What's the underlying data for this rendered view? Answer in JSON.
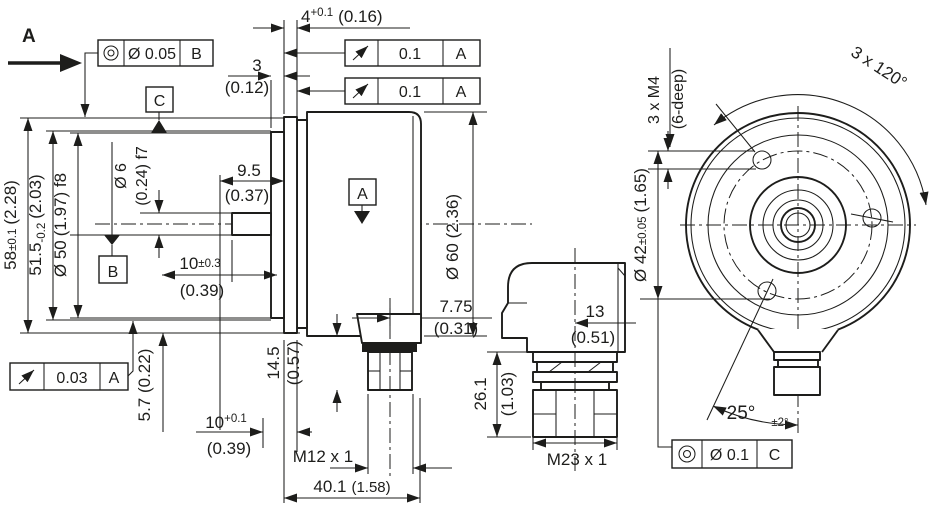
{
  "drawing_title": "Rotary encoder dimensional drawing, three views",
  "colors": {
    "line": "#1d1d1b",
    "background": "#ffffff"
  },
  "view_a": {
    "label": "A"
  },
  "datums": {
    "a": "A",
    "b": "B",
    "c": "C"
  },
  "frames": {
    "concentricity_top": {
      "symbol": "concentricity-bullseye",
      "value": "Ø 0.05",
      "datum": "B"
    },
    "runout_1": {
      "symbol": "runout-arrow",
      "value": "0.1",
      "datum": "A"
    },
    "runout_2": {
      "symbol": "runout-arrow",
      "value": "0.1",
      "datum": "A"
    },
    "runout_bottom": {
      "symbol": "runout-arrow",
      "value": "0.03",
      "datum": "A"
    },
    "concentricity_right": {
      "symbol": "concentricity-bullseye",
      "value": "Ø 0.1",
      "datum": "C"
    }
  },
  "side_view": {
    "dim_flange_thickness": {
      "value": "4",
      "tol": "+0.1",
      "inch": "(0.16)"
    },
    "dim_collar_thickness": {
      "value": "3",
      "inch": "(0.12)"
    },
    "dim_flange_diameter": {
      "value": "58",
      "tol": "±0.1",
      "inch": "(2.28)"
    },
    "dim_fit_diameter": {
      "value": "51.5",
      "tol": "-0.2",
      "inch": "(2.03)"
    },
    "dim_collar_diameter": {
      "value": "Ø 50",
      "inch_fit": "(1.97) f8"
    },
    "dim_shaft_diameter": {
      "value": "Ø 6",
      "inch_fit": "(0.24) f7"
    },
    "dim_shaft_usable": {
      "value": "9.5",
      "inch": "(0.37)"
    },
    "dim_shaft_length": {
      "value": "10",
      "tol": "±0.3",
      "inch": "(0.39)"
    },
    "dim_body_diameter": {
      "value": "Ø 60 (2.36)"
    },
    "dim_connector_offset": {
      "value": "7.75",
      "inch": "(0.31)"
    },
    "dim_connector_height": {
      "value": "14.5",
      "inch": "(0.57)"
    },
    "dim_screw_offset": {
      "value": "5.7 (0.22)"
    },
    "dim_screw_depth": {
      "value": "10",
      "tol": "+0.1",
      "inch": "(0.39)"
    },
    "dim_thread_m12": {
      "value": "M12 x 1"
    },
    "dim_body_length": {
      "value": "40.1",
      "inch": "(1.58)"
    }
  },
  "mid_view": {
    "dim_connector_center": {
      "value": "13",
      "inch": "(0.51)"
    },
    "dim_connector_length": {
      "value": "26.1",
      "inch": "(1.03)"
    },
    "dim_thread_m23": {
      "value": "M23 x 1"
    }
  },
  "right_view": {
    "dim_hole_pattern": {
      "value": "3 x 120°"
    },
    "dim_mounting_holes": {
      "value": "3 x M4",
      "depth": "(6-deep)"
    },
    "dim_bolt_circle": {
      "value": "Ø 42",
      "tol": "±0.05",
      "inch": "(1.65)"
    },
    "dim_connector_angle": {
      "value": "25°",
      "tol": "±2°"
    }
  }
}
